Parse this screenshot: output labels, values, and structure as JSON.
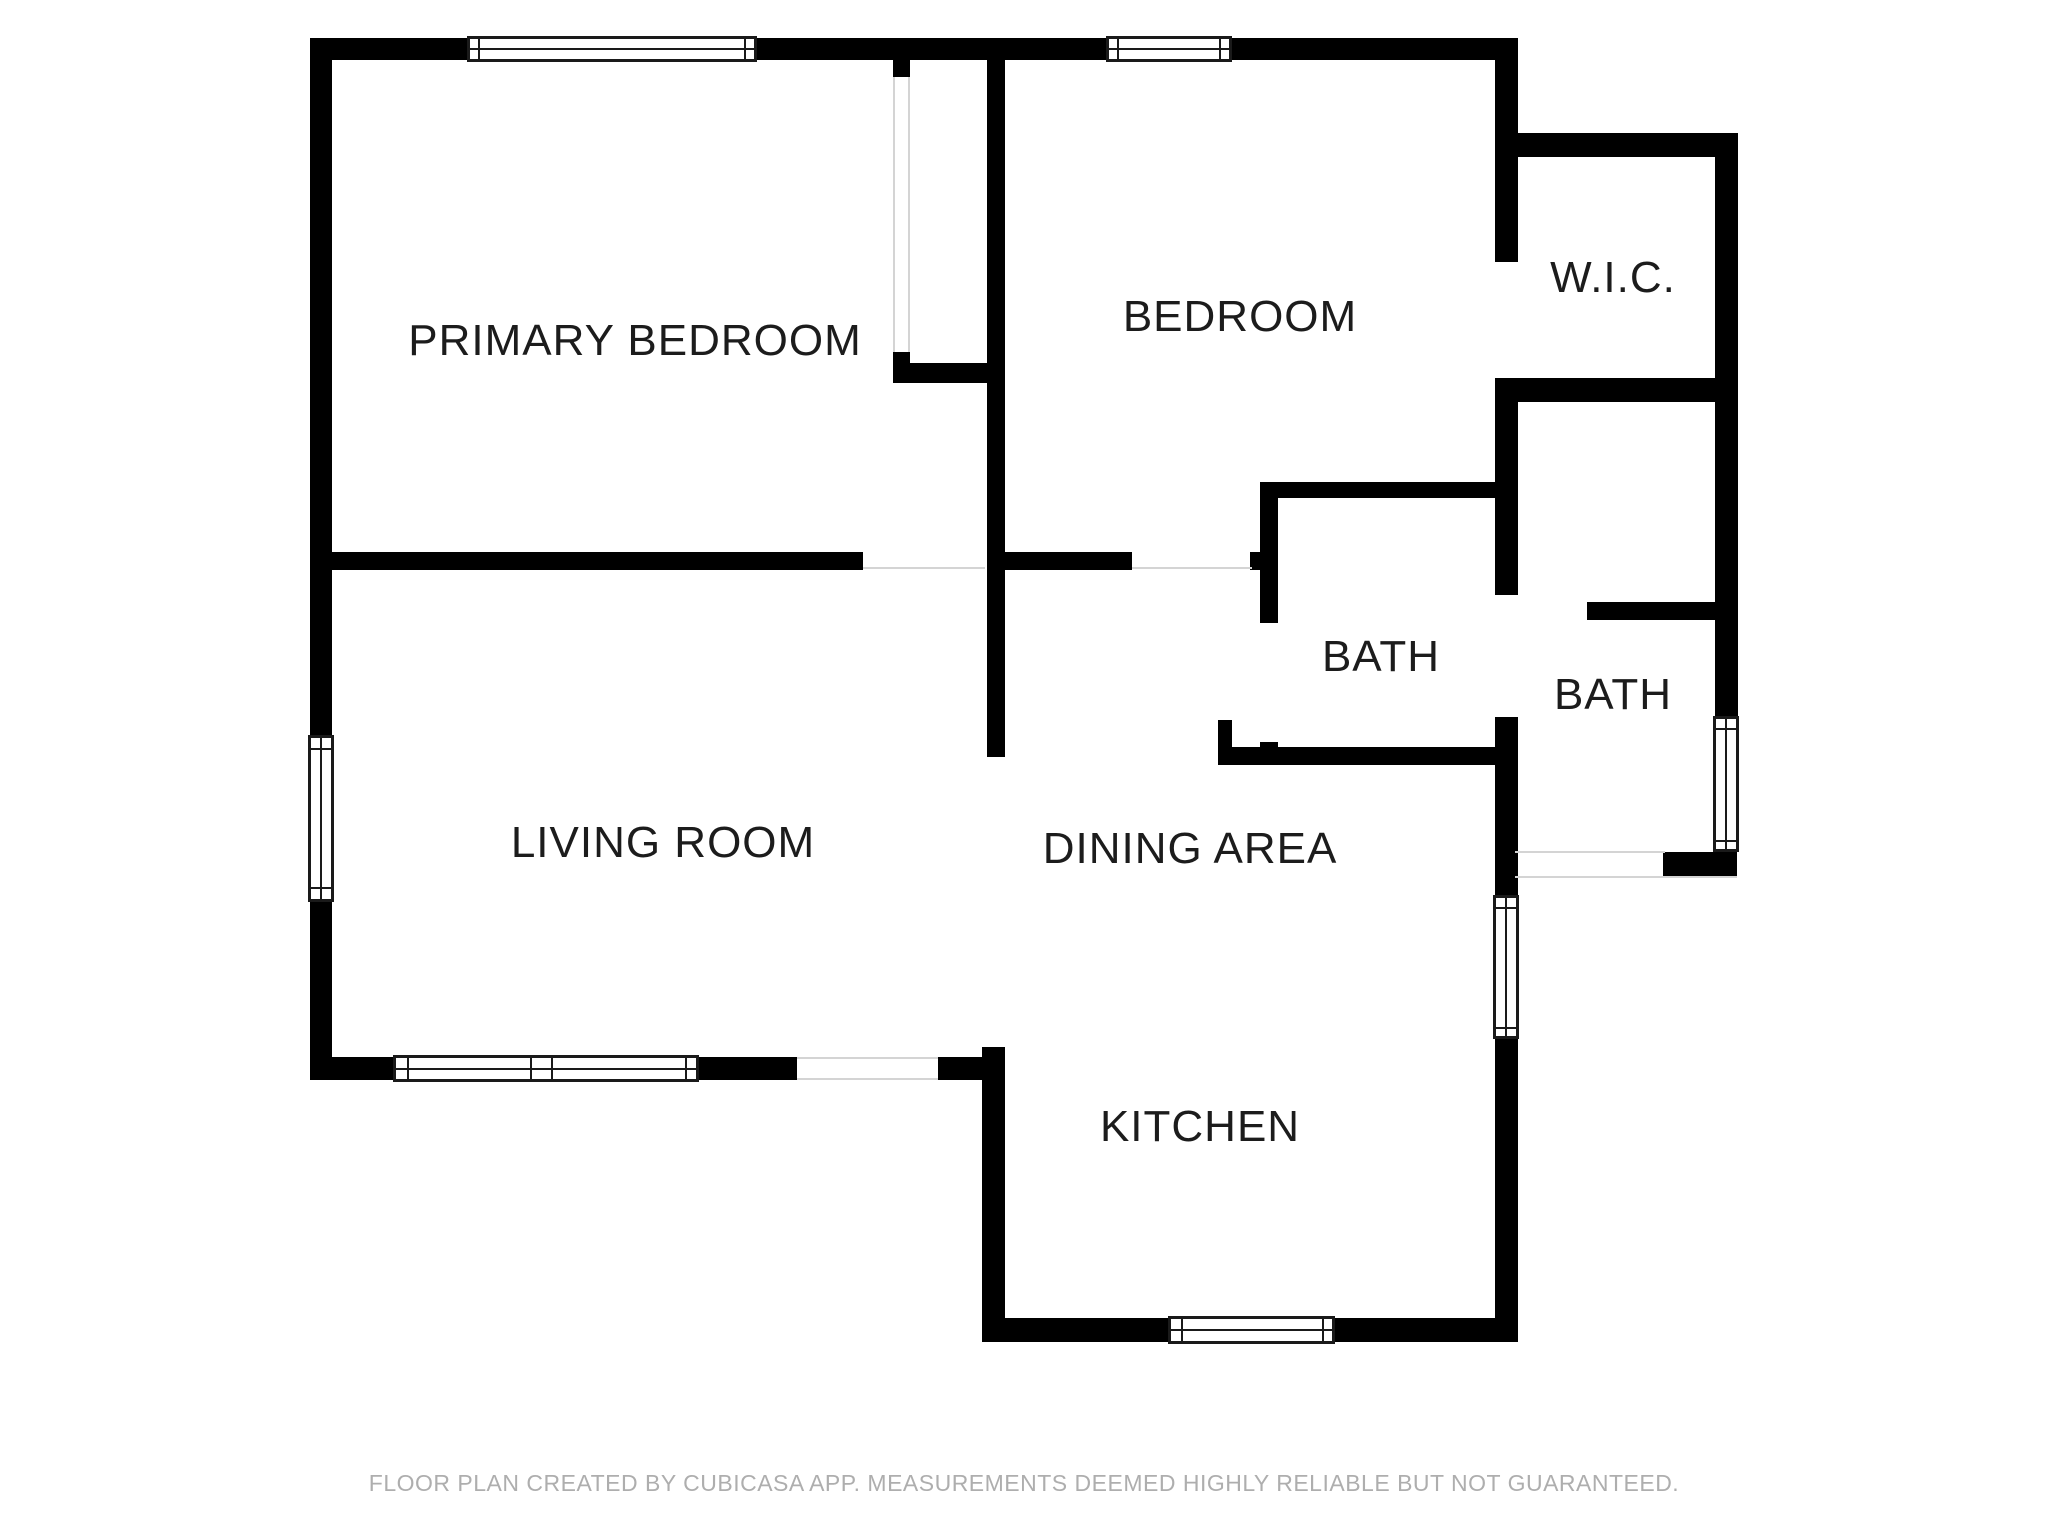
{
  "canvas": {
    "width": 2048,
    "height": 1536
  },
  "colors": {
    "wall": "#000000",
    "window_frame": "#1a1a1a",
    "thin_line": "#d4d4d4",
    "label_text": "#1c1c1c",
    "footer_text": "#aeaeae",
    "background": "#ffffff"
  },
  "rooms": [
    {
      "id": "primary-bedroom",
      "label": "PRIMARY BEDROOM",
      "cx": 635,
      "cy": 341
    },
    {
      "id": "bedroom",
      "label": "BEDROOM",
      "cx": 1240,
      "cy": 317
    },
    {
      "id": "wic",
      "label": "W.I.C.",
      "cx": 1613,
      "cy": 278
    },
    {
      "id": "bath-inner",
      "label": "BATH",
      "cx": 1381,
      "cy": 657
    },
    {
      "id": "bath-outer",
      "label": "BATH",
      "cx": 1613,
      "cy": 695
    },
    {
      "id": "living-room",
      "label": "LIVING ROOM",
      "cx": 663,
      "cy": 843
    },
    {
      "id": "dining-area",
      "label": "DINING AREA",
      "cx": 1190,
      "cy": 849
    },
    {
      "id": "kitchen",
      "label": "KITCHEN",
      "cx": 1200,
      "cy": 1127
    }
  ],
  "walls": [
    {
      "name": "wall-exterior-top",
      "x": 310,
      "y": 38,
      "w": 1208,
      "h": 22
    },
    {
      "name": "wall-exterior-left",
      "x": 310,
      "y": 38,
      "w": 22,
      "h": 1042
    },
    {
      "name": "wall-living-south-west",
      "x": 310,
      "y": 1057,
      "w": 487,
      "h": 23
    },
    {
      "name": "wall-living-south-east",
      "x": 938,
      "y": 1057,
      "w": 67,
      "h": 23
    },
    {
      "name": "wall-kitchen-west",
      "x": 982,
      "y": 1047,
      "w": 23,
      "h": 295
    },
    {
      "name": "wall-kitchen-south",
      "x": 982,
      "y": 1318,
      "w": 536,
      "h": 24
    },
    {
      "name": "wall-east-upper",
      "x": 1495,
      "y": 38,
      "w": 23,
      "h": 224
    },
    {
      "name": "wall-east-mid",
      "x": 1495,
      "y": 378,
      "w": 23,
      "h": 217
    },
    {
      "name": "wall-east-lower",
      "x": 1495,
      "y": 717,
      "w": 23,
      "h": 625
    },
    {
      "name": "wall-middle-vertical",
      "x": 987,
      "y": 38,
      "w": 18,
      "h": 719
    },
    {
      "name": "wall-divider-west",
      "x": 332,
      "y": 552,
      "w": 531,
      "h": 18
    },
    {
      "name": "wall-divider-east",
      "x": 1005,
      "y": 552,
      "w": 127,
      "h": 18
    },
    {
      "name": "wall-divider-stub",
      "x": 1250,
      "y": 552,
      "w": 10,
      "h": 18
    },
    {
      "name": "wall-closet-stub-top",
      "x": 893,
      "y": 60,
      "w": 17,
      "h": 17
    },
    {
      "name": "wall-closet-stub-bottom",
      "x": 893,
      "y": 352,
      "w": 17,
      "h": 26
    },
    {
      "name": "wall-closet-south",
      "x": 893,
      "y": 363,
      "w": 112,
      "h": 20
    },
    {
      "name": "wall-bath-inner-north",
      "x": 1260,
      "y": 482,
      "w": 237,
      "h": 16
    },
    {
      "name": "wall-bath-inner-west-upper",
      "x": 1260,
      "y": 482,
      "w": 18,
      "h": 141
    },
    {
      "name": "wall-bath-inner-west-lower",
      "x": 1260,
      "y": 742,
      "w": 18,
      "h": 23
    },
    {
      "name": "wall-bath-inner-south",
      "x": 1218,
      "y": 747,
      "w": 279,
      "h": 18
    },
    {
      "name": "wall-bath-inner-doorstop",
      "x": 1218,
      "y": 720,
      "w": 14,
      "h": 27
    },
    {
      "name": "wall-wic-north",
      "x": 1497,
      "y": 133,
      "w": 241,
      "h": 24
    },
    {
      "name": "wall-wic-east",
      "x": 1715,
      "y": 133,
      "w": 23,
      "h": 269
    },
    {
      "name": "wall-wic-south",
      "x": 1497,
      "y": 378,
      "w": 218,
      "h": 24
    },
    {
      "name": "wall-bath-outer-east",
      "x": 1715,
      "y": 402,
      "w": 23,
      "h": 316
    },
    {
      "name": "wall-bath-outer-interior",
      "x": 1587,
      "y": 602,
      "w": 150,
      "h": 18
    },
    {
      "name": "wall-bath-outer-south",
      "x": 1663,
      "y": 852,
      "w": 74,
      "h": 25
    }
  ],
  "door_openings": [
    {
      "name": "door-primary-bedroom",
      "x": 863,
      "y": 552,
      "w": 122,
      "h": 18
    },
    {
      "name": "door-bedroom",
      "x": 1132,
      "y": 552,
      "w": 120,
      "h": 18
    },
    {
      "name": "door-wic",
      "x": 1495,
      "y": 262,
      "w": 23,
      "h": 116
    },
    {
      "name": "door-bath-inner",
      "x": 1260,
      "y": 623,
      "w": 18,
      "h": 119
    },
    {
      "name": "door-bath-outer",
      "x": 1495,
      "y": 595,
      "w": 23,
      "h": 122
    },
    {
      "name": "door-living-south",
      "x": 797,
      "y": 1059,
      "w": 141,
      "h": 19
    },
    {
      "name": "door-rear",
      "x": 1518,
      "y": 853,
      "w": 145,
      "h": 22
    },
    {
      "name": "opening-closet",
      "x": 895,
      "y": 77,
      "w": 13,
      "h": 275
    }
  ],
  "thin_lines": [
    {
      "name": "line-primary-door-plane",
      "x": 863,
      "y": 567,
      "w": 122,
      "h": 2
    },
    {
      "name": "line-bedroom-door-plane",
      "x": 1132,
      "y": 567,
      "w": 120,
      "h": 2
    },
    {
      "name": "line-living-door-top",
      "x": 797,
      "y": 1057,
      "w": 141,
      "h": 2
    },
    {
      "name": "line-living-door-bottom",
      "x": 797,
      "y": 1078,
      "w": 141,
      "h": 2
    },
    {
      "name": "line-rear-opening-top",
      "x": 1515,
      "y": 851,
      "w": 150,
      "h": 2
    },
    {
      "name": "line-rear-opening-bottom",
      "x": 1515,
      "y": 876,
      "w": 222,
      "h": 2
    },
    {
      "name": "line-closet-opening-left",
      "x": 893,
      "y": 77,
      "w": 2,
      "h": 275
    },
    {
      "name": "line-closet-opening-right",
      "x": 908,
      "y": 77,
      "w": 2,
      "h": 275
    }
  ],
  "windows": [
    {
      "name": "window-primary-north",
      "x": 467,
      "y": 36,
      "w": 290,
      "h": 26,
      "o": "h",
      "dividers": [
        11,
        277
      ]
    },
    {
      "name": "window-bedroom-north",
      "x": 1106,
      "y": 36,
      "w": 126,
      "h": 26,
      "o": "h",
      "dividers": [
        11,
        113
      ]
    },
    {
      "name": "window-living-west",
      "x": 308,
      "y": 735,
      "w": 26,
      "h": 167,
      "o": "v",
      "dividers": [
        13,
        152
      ]
    },
    {
      "name": "window-living-south",
      "x": 393,
      "y": 1055,
      "w": 306,
      "h": 27,
      "o": "h",
      "dividers": [
        14,
        137,
        158,
        292
      ]
    },
    {
      "name": "window-kitchen-south",
      "x": 1168,
      "y": 1316,
      "w": 167,
      "h": 28,
      "o": "h",
      "dividers": [
        13,
        154
      ]
    },
    {
      "name": "window-kitchen-east",
      "x": 1493,
      "y": 895,
      "w": 26,
      "h": 144,
      "o": "v",
      "dividers": [
        12,
        132
      ]
    },
    {
      "name": "window-bath-east",
      "x": 1713,
      "y": 716,
      "w": 26,
      "h": 136,
      "o": "v",
      "dividers": [
        12,
        124
      ]
    }
  ],
  "footer": {
    "text": "FLOOR PLAN CREATED BY CUBICASA APP. MEASUREMENTS DEEMED HIGHLY RELIABLE BUT NOT GUARANTEED."
  }
}
